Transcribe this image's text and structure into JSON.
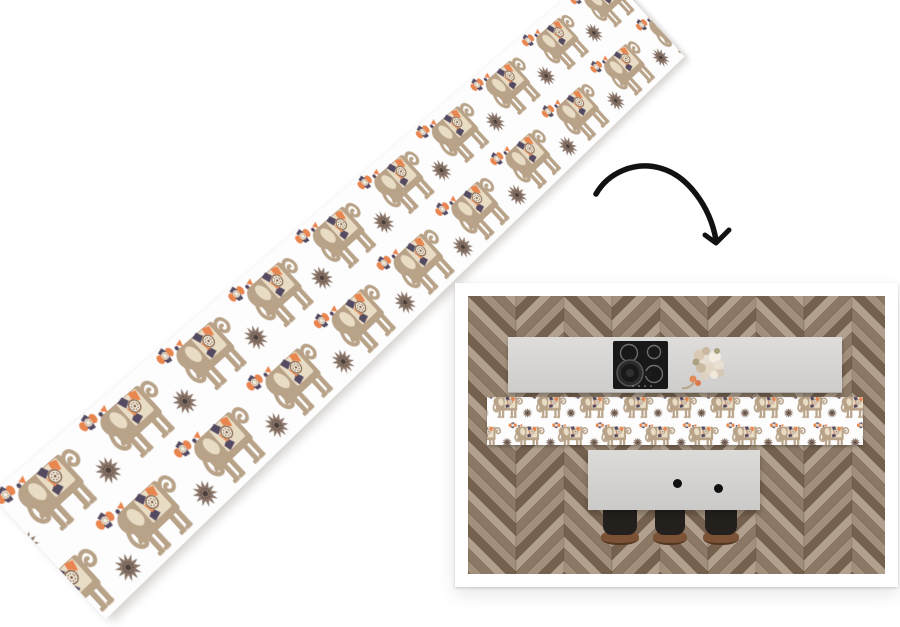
{
  "page": {
    "type": "product-image",
    "visible_text": "none"
  },
  "labels": {
    "stage": "Product photo of a white kitchen runner mat with elephant pattern",
    "runner_unrolled": "Unrolled elephant runner shown diagonally in perspective",
    "arrow": "Hand-drawn curved arrow pointing to the room scene",
    "room_photo": "Top-down kitchen scene: herringbone floor, counter with cooktop and bouquet, elephant runner, island with three stools"
  },
  "product": {
    "item": "kitchen runner mat",
    "base_color_name": "white",
    "pattern_motifs": [
      "elephant with kilim blanket",
      "twelve-point star flower",
      "small kilim flower"
    ]
  },
  "room_photo": {
    "floor_style": "herringbone parquet",
    "elements": [
      "counter",
      "cooktop with 4 burners",
      "pan",
      "flower bouquet",
      "runner mat",
      "island with 2 sink bowls",
      "3 stools"
    ],
    "burner_count": 4,
    "stool_count": 3,
    "island_bowl_count": 2
  },
  "css_vars": {
    "page-bg": "#ffffff",
    "mat-white": "#fdfdfd",
    "frame-white": "#ffffff",
    "elephant-body": "#b8a288",
    "elephant-cream": "#e9dcc4",
    "accent-orange": "#e9854f",
    "accent-purple": "#544a62",
    "medallion-brown": "#7c5a40",
    "star-brown": "#8a7568",
    "arrow-black": "#121212",
    "floor-a": "#b1a08d",
    "floor-b": "#8c7965",
    "floor-c": "#a2907c",
    "floor-d": "#75614e",
    "counter-gray": "#d9d8d6",
    "hob-black": "#181818",
    "island-gray": "#d8d7d5",
    "stool-black": "#24201d",
    "stool-brown": "#7b5236"
  }
}
